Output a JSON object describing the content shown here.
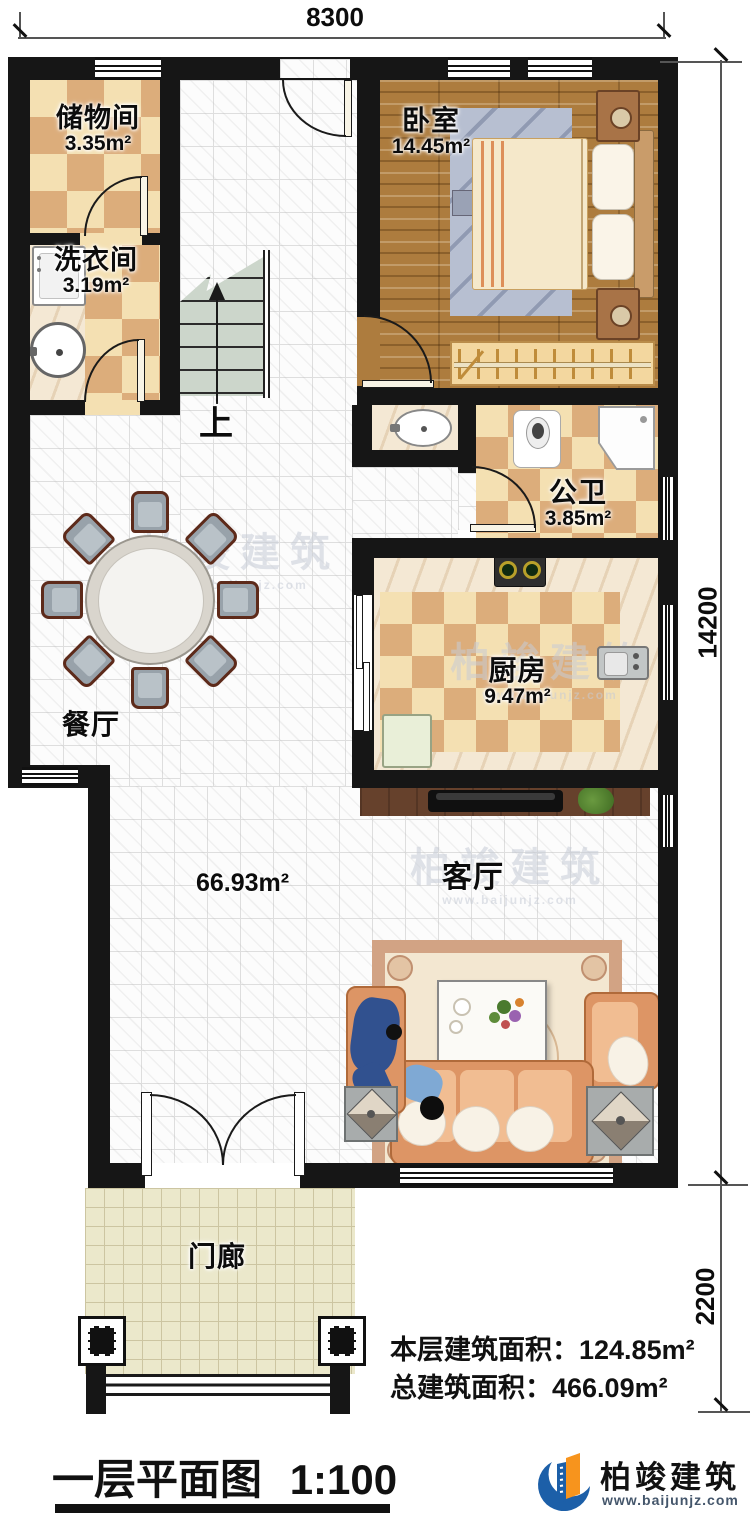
{
  "dimensions": {
    "top": "8300",
    "side_main": "14200",
    "side_porch": "2200"
  },
  "rooms": {
    "storage": {
      "name": "储物间",
      "area": "3.35m²"
    },
    "laundry": {
      "name": "洗衣间",
      "area": "3.19m²"
    },
    "bedroom": {
      "name": "卧室",
      "area": "14.45m²"
    },
    "bathroom": {
      "name": "公卫",
      "area": "3.85m²"
    },
    "kitchen": {
      "name": "厨房",
      "area": "9.47m²"
    },
    "dining": {
      "name": "餐厅"
    },
    "living": {
      "name": "客厅"
    },
    "porch": {
      "name": "门廊"
    },
    "hall_area": "66.93m²",
    "stairs_label": "上"
  },
  "summary": {
    "floor_label": "本层建筑面积：",
    "floor_value": "124.85m²",
    "total_label": "总建筑面积：",
    "total_value": "466.09m²"
  },
  "title_block": {
    "title": "一层平面图",
    "scale": "1:100"
  },
  "brand": {
    "name": "柏竣建筑",
    "url": "www.baijunjz.com",
    "blue": "#1c5fa8",
    "orange": "#f7941d"
  },
  "watermark": {
    "text": "柏竣建筑",
    "url": "www.baijunjz.com"
  }
}
